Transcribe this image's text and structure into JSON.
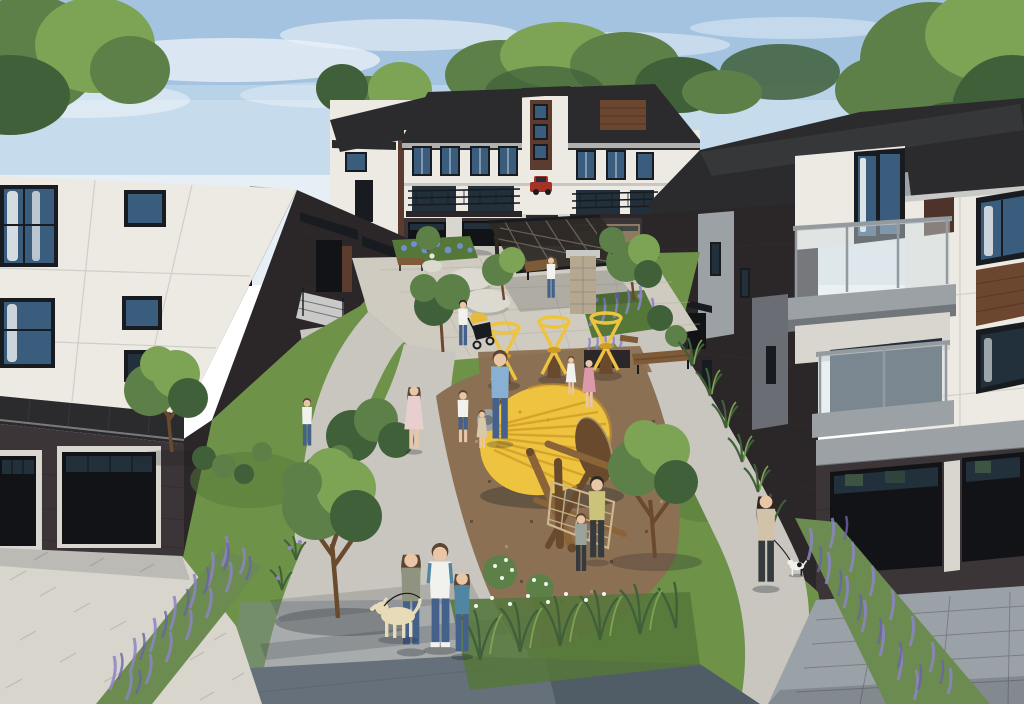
{
  "scene": {
    "type": "architectural-rendering",
    "visible_text": "none",
    "description": "Aerial rendering of a modern three-storey townhome community: two foreground townhome blocks with white panel siding, dark brick bases and black garage doors flank a landscaped central courtyard with a pergola seating plaza, natural playground (yellow cone climber, log and rope climber, yellow spinner toys), curved walkways, lavender beds, ornamental grasses, trees, and residents walking with children and dogs. A rear row of townhomes with balconies and a red parked car closes the view under a blue sky with wispy clouds.",
    "objects": [
      "sky",
      "clouds",
      "background-trees",
      "rear-townhome-row",
      "red-car",
      "left-townhome",
      "right-townhome",
      "balconies",
      "garage-doors",
      "courtyard-plaza",
      "pergola",
      "stone-pillar",
      "boulders",
      "benches",
      "playground-cone",
      "log-climber",
      "climbing-net",
      "spinner-toys",
      "walking-paths",
      "lavender-beds",
      "flower-beds",
      "ornamental-grasses",
      "trees",
      "shrubs",
      "family-walking-dog",
      "woman-walking-small-dog",
      "woman-with-stroller",
      "adults-with-children",
      "labrador-dog",
      "small-dog"
    ]
  },
  "colors": {
    "sky_top": "#a3c3e0",
    "sky_mid": "#c6dcec",
    "sky_low": "#e6eff5",
    "cloud": "#ffffff",
    "tree_dark": "#40603a",
    "tree_mid": "#5d8048",
    "tree_light": "#7da355",
    "roof": "#2b2b2d",
    "roof_light": "#404144",
    "fascia": "#c9cac8",
    "white_panel": "#eceae3",
    "white_panel_shade": "#d8d6cf",
    "seam": "#c9c7c0",
    "gray_panel": "#9ba1a5",
    "gray_panel_dark": "#71767b",
    "brick_dark": "#2b2628",
    "brick_mid": "#3c3537",
    "brick_red": "#5c3c2e",
    "brick_warm": "#4e332a",
    "frame": "#181c20",
    "glass": "#3a5d7e",
    "glass_dark": "#22303c",
    "glass_rail": "#d3dde3",
    "curtain": "#f0f2f3",
    "garage_black": "#121316",
    "garage_tan": "#8e7a5f",
    "wood_accent": "#6d462f",
    "rail_post": "#949a9e",
    "plaza": "#d0cbc0",
    "path": "#c8c6bf",
    "path_shadow": "#7e8a94",
    "walk_dark": "#505c66",
    "paver_light": "#d8d5cd",
    "paver_line": "#b2afa6",
    "paver_cool": "#9aa1a7",
    "lawn": "#6e9247",
    "lawn_dark": "#55773a",
    "mulch": "#8c7054",
    "mulch_dark": "#63503c",
    "mulch_light": "#a98e6c",
    "stone_pillar": "#b5a88e",
    "boulder": "#dbd9d0",
    "boulder_shade": "#a8a69c",
    "lavender": "#8c84c6",
    "lavender_dark": "#6c63aa",
    "lavender_stem": "#6b8b50",
    "flower_blue": "#7090cc",
    "flower_white": "#f3f5ef",
    "play_yellow": "#eec33f",
    "play_yellow_dark": "#cf9a26",
    "log": "#8b6339",
    "log_dark": "#6a4a2d",
    "rope": "#cdb78e",
    "pergola": "#2d2925",
    "bench_wood": "#7d5b39",
    "car_red": "#a33328",
    "skin": "#e9c6a6",
    "hair_brown": "#5b4530",
    "hair_dark": "#2f2721",
    "denim": "#44618b",
    "shirt_white": "#f1f1ed",
    "shirt_blue": "#87b0d2",
    "shirt_gray": "#9ba19b",
    "shirt_olive": "#90937f",
    "shirt_teal": "#5086a1",
    "shirt_pink": "#dd99a9",
    "shirt_yellow": "#cac379",
    "shirt_beige": "#d0c3a9",
    "pants_dark": "#343a3e",
    "dress_pink": "#e7cecf",
    "dress_beige": "#d9c9a8",
    "dog_cream": "#e8dbb7",
    "stroller_yellow": "#e7ba3d",
    "shadow": "#1c2126"
  }
}
